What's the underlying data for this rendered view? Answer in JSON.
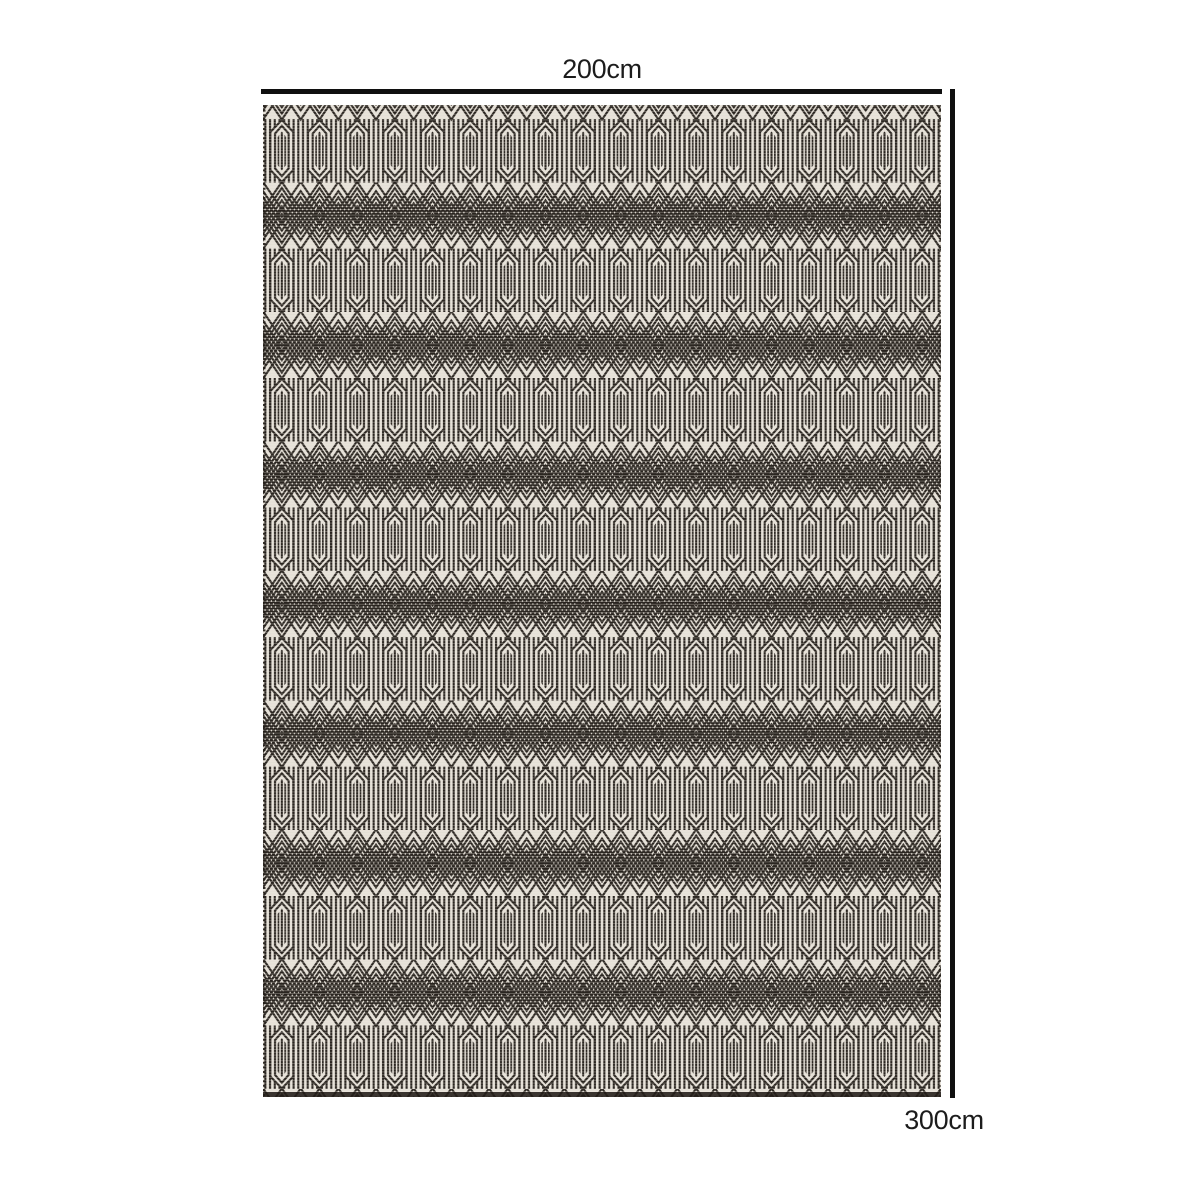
{
  "diagram": {
    "type": "product-dimension-diagram",
    "subject": "black and cream geometric flatweave rug",
    "width_label": "200cm",
    "height_label": "300cm"
  },
  "colors": {
    "background": "#ffffff",
    "dimension_line": "#101010",
    "label_text": "#1c1c1c",
    "rug_dark": "#221d18",
    "rug_light": "#e7e2d9"
  }
}
